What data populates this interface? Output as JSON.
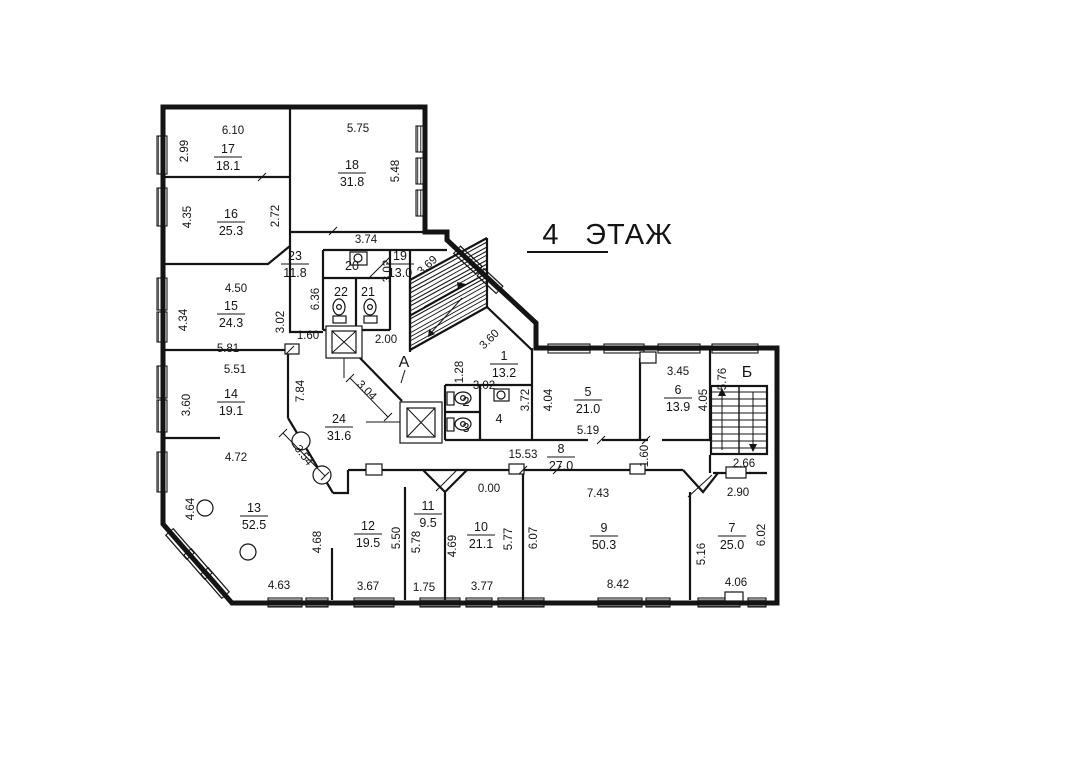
{
  "title": {
    "floor_number": "4",
    "floor_label": "ЭТАЖ"
  },
  "stairwells": [
    {
      "label": "А",
      "x": 404,
      "y": 362
    },
    {
      "label": "Б",
      "x": 747,
      "y": 372
    }
  ],
  "rooms": [
    {
      "number": "1",
      "area": "13.2",
      "x": 504,
      "y": 364
    },
    {
      "number": "2",
      "x": 466,
      "y": 402
    },
    {
      "number": "3",
      "x": 466,
      "y": 428
    },
    {
      "number": "4",
      "x": 499,
      "y": 419
    },
    {
      "number": "5",
      "area": "21.0",
      "x": 588,
      "y": 400
    },
    {
      "number": "6",
      "area": "13.9",
      "x": 678,
      "y": 398
    },
    {
      "number": "7",
      "area": "25.0",
      "x": 732,
      "y": 536
    },
    {
      "number": "8",
      "area": "27.0",
      "x": 561,
      "y": 457
    },
    {
      "number": "9",
      "area": "50.3",
      "x": 604,
      "y": 536
    },
    {
      "number": "10",
      "area": "21.1",
      "x": 481,
      "y": 535
    },
    {
      "number": "11",
      "area": "9.5",
      "x": 428,
      "y": 514
    },
    {
      "number": "12",
      "area": "19.5",
      "x": 368,
      "y": 534
    },
    {
      "number": "13",
      "area": "52.5",
      "x": 254,
      "y": 516
    },
    {
      "number": "14",
      "area": "19.1",
      "x": 231,
      "y": 402
    },
    {
      "number": "15",
      "area": "24.3",
      "x": 231,
      "y": 314
    },
    {
      "number": "16",
      "area": "25.3",
      "x": 231,
      "y": 222
    },
    {
      "number": "17",
      "area": "18.1",
      "x": 228,
      "y": 157
    },
    {
      "number": "18",
      "area": "31.8",
      "x": 352,
      "y": 173
    },
    {
      "number": "19",
      "area": "13.0",
      "x": 400,
      "y": 264
    },
    {
      "number": "20",
      "x": 352,
      "y": 266
    },
    {
      "number": "21",
      "x": 368,
      "y": 292
    },
    {
      "number": "22",
      "x": 341,
      "y": 292
    },
    {
      "number": "23",
      "area": "11.8",
      "x": 295,
      "y": 264
    },
    {
      "number": "24",
      "area": "31.6",
      "x": 339,
      "y": 427
    }
  ],
  "dimensions": [
    {
      "value": "6.10",
      "x": 233,
      "y": 130,
      "rot": 0
    },
    {
      "value": "2.99",
      "x": 184,
      "y": 151,
      "rot": -90
    },
    {
      "value": "5.75",
      "x": 358,
      "y": 128,
      "rot": 0
    },
    {
      "value": "5.48",
      "x": 395,
      "y": 171,
      "rot": -90
    },
    {
      "value": "4.35",
      "x": 187,
      "y": 217,
      "rot": -90
    },
    {
      "value": "2.72",
      "x": 275,
      "y": 216,
      "rot": -90
    },
    {
      "value": "3.74",
      "x": 366,
      "y": 239,
      "rot": 0
    },
    {
      "value": "3.69",
      "x": 427,
      "y": 265,
      "rot": -42
    },
    {
      "value": "3.02",
      "x": 387,
      "y": 271,
      "rot": -90
    },
    {
      "value": "6.36",
      "x": 315,
      "y": 299,
      "rot": -90
    },
    {
      "value": "4.50",
      "x": 236,
      "y": 288,
      "rot": 0
    },
    {
      "value": "4.34",
      "x": 183,
      "y": 320,
      "rot": -90
    },
    {
      "value": "3.02",
      "x": 280,
      "y": 322,
      "rot": -90
    },
    {
      "value": "1.60",
      "x": 308,
      "y": 335,
      "rot": 0
    },
    {
      "value": "5.81",
      "x": 228,
      "y": 348,
      "rot": 0
    },
    {
      "value": "2.00",
      "x": 386,
      "y": 339,
      "rot": 0
    },
    {
      "value": "5.51",
      "x": 235,
      "y": 369,
      "rot": 0
    },
    {
      "value": "7.84",
      "x": 300,
      "y": 391,
      "rot": -90
    },
    {
      "value": "3.60",
      "x": 186,
      "y": 405,
      "rot": -90
    },
    {
      "value": "3.04",
      "x": 367,
      "y": 390,
      "rot": 45
    },
    {
      "value": "3.60",
      "x": 489,
      "y": 339,
      "rot": -45
    },
    {
      "value": "1.28",
      "x": 459,
      "y": 372,
      "rot": -90
    },
    {
      "value": "3.02",
      "x": 484,
      "y": 385,
      "rot": 0
    },
    {
      "value": "3.72",
      "x": 525,
      "y": 400,
      "rot": -90
    },
    {
      "value": "4.04",
      "x": 548,
      "y": 400,
      "rot": -90
    },
    {
      "value": "5.19",
      "x": 588,
      "y": 430,
      "rot": 0
    },
    {
      "value": "3.45",
      "x": 678,
      "y": 371,
      "rot": 0
    },
    {
      "value": "4.05",
      "x": 703,
      "y": 400,
      "rot": -90
    },
    {
      "value": "5.76",
      "x": 722,
      "y": 379,
      "rot": -90
    },
    {
      "value": "2.66",
      "x": 744,
      "y": 463,
      "rot": 0
    },
    {
      "value": "2.90",
      "x": 738,
      "y": 492,
      "rot": 0
    },
    {
      "value": "15.53",
      "x": 523,
      "y": 454,
      "rot": 0
    },
    {
      "value": "1.60",
      "x": 644,
      "y": 456,
      "rot": -90
    },
    {
      "value": "7.43",
      "x": 598,
      "y": 493,
      "rot": 0
    },
    {
      "value": "0.00",
      "x": 489,
      "y": 488,
      "rot": 0
    },
    {
      "value": "4.72",
      "x": 236,
      "y": 457,
      "rot": 0
    },
    {
      "value": "3.54",
      "x": 304,
      "y": 455,
      "rot": 52
    },
    {
      "value": "4.64",
      "x": 190,
      "y": 509,
      "rot": -90
    },
    {
      "value": "4.68",
      "x": 317,
      "y": 542,
      "rot": -90
    },
    {
      "value": "5.50",
      "x": 396,
      "y": 538,
      "rot": -90
    },
    {
      "value": "5.78",
      "x": 416,
      "y": 542,
      "rot": -90
    },
    {
      "value": "4.69",
      "x": 452,
      "y": 546,
      "rot": -90
    },
    {
      "value": "5.77",
      "x": 508,
      "y": 539,
      "rot": -90
    },
    {
      "value": "6.07",
      "x": 533,
      "y": 538,
      "rot": -90
    },
    {
      "value": "5.16",
      "x": 701,
      "y": 554,
      "rot": -90
    },
    {
      "value": "6.02",
      "x": 761,
      "y": 535,
      "rot": -90
    },
    {
      "value": "4.63",
      "x": 279,
      "y": 585,
      "rot": 0
    },
    {
      "value": "3.67",
      "x": 368,
      "y": 586,
      "rot": 0
    },
    {
      "value": "1.75",
      "x": 424,
      "y": 587,
      "rot": 0
    },
    {
      "value": "3.77",
      "x": 482,
      "y": 586,
      "rot": 0
    },
    {
      "value": "8.42",
      "x": 618,
      "y": 584,
      "rot": 0
    },
    {
      "value": "4.06",
      "x": 736,
      "y": 582,
      "rot": 0
    }
  ],
  "ink_color": "#141414"
}
